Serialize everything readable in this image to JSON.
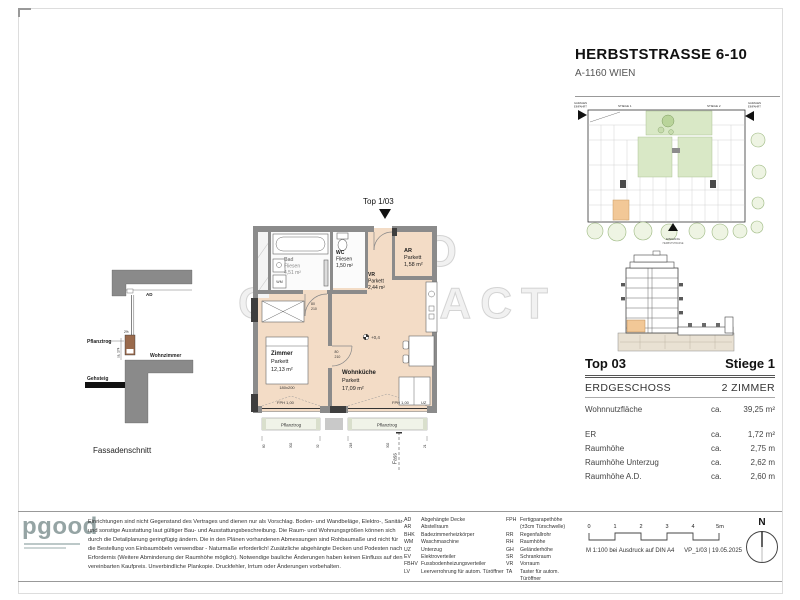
{
  "header": {
    "title": "HERBSTSTRASSE 6-10",
    "subtitle": "A-1160 WIEN"
  },
  "watermark": {
    "line1": "IMMO",
    "line2": "CONTRACT"
  },
  "site_plan": {
    "stiege1": "STIEGE 1",
    "stiege2": "STIEGE 2",
    "garage_left1": "GARAGEN",
    "garage_left2": "EINFAHRT",
    "garage_right1": "GARAGEN",
    "garage_right2": "EINFAHRT",
    "entrance": "EINGANG",
    "street": "HERBSTSTRASSE"
  },
  "floor_plan": {
    "top_label": "Top 1/03",
    "rooms": {
      "bad": {
        "name": "Bad",
        "floor": "Fliesen",
        "area": "4,51 m²"
      },
      "wc": {
        "name": "WC",
        "floor": "Fliesen",
        "area": "1,50 m²"
      },
      "vr": {
        "name": "VR",
        "floor": "Parkett",
        "area": "2,44 m²"
      },
      "ar": {
        "name": "AR",
        "floor": "Parkett",
        "area": "1,58 m²"
      },
      "zimmer": {
        "name": "Zimmer",
        "floor": "Parkett",
        "area": "12,13 m²"
      },
      "wohnkueche": {
        "name": "Wohnküche",
        "floor": "Parkett",
        "area": "17,09 m²"
      }
    },
    "annotations": {
      "bed": "180x200",
      "level": "+0,4",
      "fph_left": "FPH 1,00",
      "fph_right": "FPH 1,00",
      "pflanztrog_left": "Pflanztrog",
      "pflanztrog_right": "Pflanztrog",
      "uz": "UZ",
      "wm": "WM",
      "door_w": "80",
      "door_h": "210",
      "fass": "Fass"
    },
    "dims": {
      "bottom_left": [
        "80",
        "302",
        "32"
      ],
      "bottom_right": [
        "218",
        "302",
        "21"
      ]
    }
  },
  "fassadenschnitt": {
    "caption": "Fassadenschnitt",
    "ad": "AD",
    "pflanztrog": "Pflanztrog",
    "wohnzimmer": "Wohnzimmer",
    "gehsteig": "Gehsteig",
    "dim": "ca. 174",
    "slope": "2%"
  },
  "info_panel": {
    "top": "Top 03",
    "stiege": "Stiege 1",
    "floor": "ERDGESCHOSS",
    "rooms": "2 ZIMMER",
    "rows": [
      {
        "label": "Wohnnutzfläche",
        "prefix": "ca.",
        "value": "39,25 m²"
      },
      {
        "label": "ER",
        "prefix": "ca.",
        "value": "1,72 m²"
      },
      {
        "label": "Raumhöhe",
        "prefix": "ca.",
        "value": "2,75 m"
      },
      {
        "label": "Raumhöhe Unterzug",
        "prefix": "ca.",
        "value": "2,62 m"
      },
      {
        "label": "Raumhöhe A.D.",
        "prefix": "ca.",
        "value": "2,60 m"
      }
    ]
  },
  "footer": {
    "logo": "pgood",
    "disclaimer": [
      "Einrichtungen sind nicht Gegenstand des Vertrages und dienen nur als Vorschlag. Boden- und Wandbeläge, Elektro-, Sanitär-",
      "und sonstige Ausstattung laut gültiger Bau- und Ausstattungsbeschreibung. Die Raum- und Wohnungsgrößen können sich",
      "durch die Detailplanung geringfügig ändern. Die in den Plänen vorhandenen Abmessungen sind Rohbaumaße und nicht für",
      "die Bestellung von Einbaumöbeln verwendbar - Naturmaße erforderlich! Zusätzliche abgehängte Decken und Podesten nach",
      "Erfordernis (Weitere Abminderung der Raumhöhe möglich). Notwendige bauliche Änderungen haben keinen Einfluss auf den",
      "vereinbarten Kaufpreis. Unverbindliche Plankopie. Druckfehler, Irrtum oder Änderungen vorbehalten."
    ],
    "legend_col1": [
      [
        "AD",
        "Abgehängte Decke"
      ],
      [
        "AR",
        "Abstellraum"
      ],
      [
        "BHK",
        "Badezimmerheizkörper"
      ],
      [
        "WM",
        "Waschmaschine"
      ],
      [
        "UZ",
        "Unterzug"
      ],
      [
        "EV",
        "Elektroverteiler"
      ],
      [
        "FBHV",
        "Fussbodenheizungsverteiler"
      ],
      [
        "LV",
        "Leerverrohrung für autom. Türöffner"
      ]
    ],
    "legend_col2": [
      [
        "FPH",
        "Fertigparapethöhe"
      ],
      [
        "",
        "(±3cm Türschwelle)"
      ],
      [
        "RR",
        "Regenfallrohr"
      ],
      [
        "RH",
        "Raumhöhe"
      ],
      [
        "GH",
        "Geländerhöhe"
      ],
      [
        "SR",
        "Schrankraum"
      ],
      [
        "VR",
        "Vorraum"
      ],
      [
        "TA",
        "Taster für autom. Türöffner"
      ]
    ],
    "scale": {
      "ticks": [
        "0",
        "1",
        "2",
        "3",
        "4",
        "5m"
      ],
      "note": "M 1:100 bei Ausdruck auf DIN A4",
      "ref": "VP_1/03 | 19.05.2025"
    },
    "north": "N"
  }
}
